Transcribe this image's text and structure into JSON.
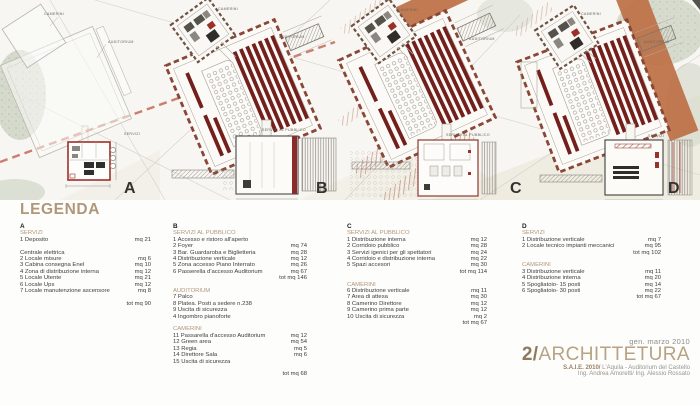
{
  "palette": {
    "accent_tan": "#b1977a",
    "seat_red": "#731f1c",
    "terracotta": "#bd7046",
    "plan_border_red": "#a03028",
    "dashed_site_line": "#c2604e"
  },
  "plans": {
    "a": {
      "letter": "A",
      "top_label": "CAMERINI",
      "mid_label": "AUDITORIUM",
      "bottom_label": "SERVIZI"
    },
    "b": {
      "letter": "B",
      "top_label": "CAMERINI",
      "mid_label": "AUDITORIUM",
      "bottom_label": "SERVIZI AL PUBBLICO"
    },
    "c": {
      "letter": "C",
      "top_label": "CAMERINI",
      "mid_label": "AUDITORIUM",
      "bottom_label": "SERVIZI AL PUBBLICO"
    },
    "d": {
      "letter": "D",
      "top_label": "CAMERINI",
      "mid_label": "AUDITORIUM",
      "bottom_label": "SERVIZI"
    }
  },
  "legend": {
    "title": "LEGENDA",
    "columns": [
      {
        "key": "A",
        "sections": [
          {
            "heading": "SERVIZI",
            "items": [
              {
                "label": "1 Deposito",
                "value": "mq 21"
              },
              {
                "label": "",
                "value": ""
              },
              {
                "label": "Centrale elettrica",
                "value": ""
              },
              {
                "label": "2 Locale misure",
                "value": "mq 6"
              },
              {
                "label": "3 Cabina consegna Enel",
                "value": "mq 10"
              },
              {
                "label": "4 Zona di distribuzione interna",
                "value": "mq 12"
              },
              {
                "label": "5 Locale Utente",
                "value": "mq 21"
              },
              {
                "label": "6 Locale Ups",
                "value": "mq 12"
              },
              {
                "label": "7 Locale manutenzione ascensore",
                "value": "mq 8"
              }
            ],
            "total": "tot mq 90",
            "gap": true
          }
        ]
      },
      {
        "key": "B",
        "sections": [
          {
            "heading": "SERVIZI AL PUBBLICO",
            "items": [
              {
                "label": "1 Accesso e ristoro all'aperto",
                "value": ""
              },
              {
                "label": "2 Foyer",
                "value": "mq 74"
              },
              {
                "label": "3 Bar. Guardaroba e Biglietteria",
                "value": "mq 28"
              },
              {
                "label": "4 Distribuzione verticale",
                "value": "mq 12"
              },
              {
                "label": "5 Zona accesso Piano Interrato",
                "value": "mq 26"
              },
              {
                "label": "6 Passerella d'accesso Auditorium",
                "value": "mq 67"
              }
            ],
            "total": "tot mq 146"
          },
          {
            "heading": "AUDITORIUM",
            "items": [
              {
                "label": "7 Palco",
                "value": ""
              },
              {
                "label": "8 Platea. Posti a sedere n.238",
                "value": ""
              },
              {
                "label": "9 Uscita di sicurezza",
                "value": ""
              },
              {
                "label": "4 Ingombro pianoforte",
                "value": ""
              }
            ]
          },
          {
            "heading": "CAMERINI",
            "items": [
              {
                "label": "11 Passarella d'accesso Auditorium",
                "value": "mq 12"
              },
              {
                "label": "12 Green area",
                "value": "mq 54"
              },
              {
                "label": "13 Regia",
                "value": "mq 5"
              },
              {
                "label": "14 Direttore Sala",
                "value": "mq 6"
              },
              {
                "label": "15 Uscita di sicurezza",
                "value": ""
              }
            ],
            "total": "tot mq 68",
            "gap": true
          }
        ]
      },
      {
        "key": "C",
        "sections": [
          {
            "heading": "SERVIZI AL PUBBLICO",
            "items": [
              {
                "label": "1 Distribuzione interna",
                "value": "mq 12"
              },
              {
                "label": "2 Corridoio pubblico",
                "value": "mq 28"
              },
              {
                "label": "3 Servizi igenici per gli spettatori",
                "value": "mq 24"
              },
              {
                "label": "4 Corridoio e distribuzione interna",
                "value": "mq 22"
              },
              {
                "label": "5 Spazi accesori",
                "value": "mq 30"
              }
            ],
            "total": "tot mq 114"
          },
          {
            "heading": "CAMERINI",
            "items": [
              {
                "label": "6 Distribuzione verticale",
                "value": "mq 11"
              },
              {
                "label": "7 Area di attesa",
                "value": "mq 30"
              },
              {
                "label": "8 Camerino Direttore",
                "value": "mq 12"
              },
              {
                "label": "9 Camerino prima parte",
                "value": "mq 12"
              },
              {
                "label": "10 Uscita di sicurezza",
                "value": "mq 2"
              }
            ],
            "total": "tot mq 67"
          }
        ]
      },
      {
        "key": "D",
        "sections": [
          {
            "heading": "SERVIZI",
            "items": [
              {
                "label": "1 Distribuzione verticale",
                "value": "mq 7"
              },
              {
                "label": "2 Locale tecnico impianti meccanici",
                "value": "mq 95"
              }
            ],
            "total": "tot mq 102"
          },
          {
            "heading": "CAMERINI",
            "items": [
              {
                "label": "3 Distribuzione verticale",
                "value": "mq 11"
              },
              {
                "label": "4 Distribuzione interna",
                "value": "mq 20"
              },
              {
                "label": "5 Spogliatoio- 15 posti",
                "value": "mq 14"
              },
              {
                "label": "6 Spogliatoio- 30 posti",
                "value": "mq 22"
              }
            ],
            "total": "tot mq 67"
          }
        ]
      }
    ]
  },
  "footer": {
    "date": "gen. marzo 2010",
    "title_number": "2/",
    "title_text": "ARCHITTETURA",
    "subtitle_bold": "S.A.I.E. 2010/",
    "subtitle_rest": " L'Aquila - Auditorium del Castello",
    "credits": "Ing. Andrea Amoretti/ Ing. Alessio Rossato"
  }
}
